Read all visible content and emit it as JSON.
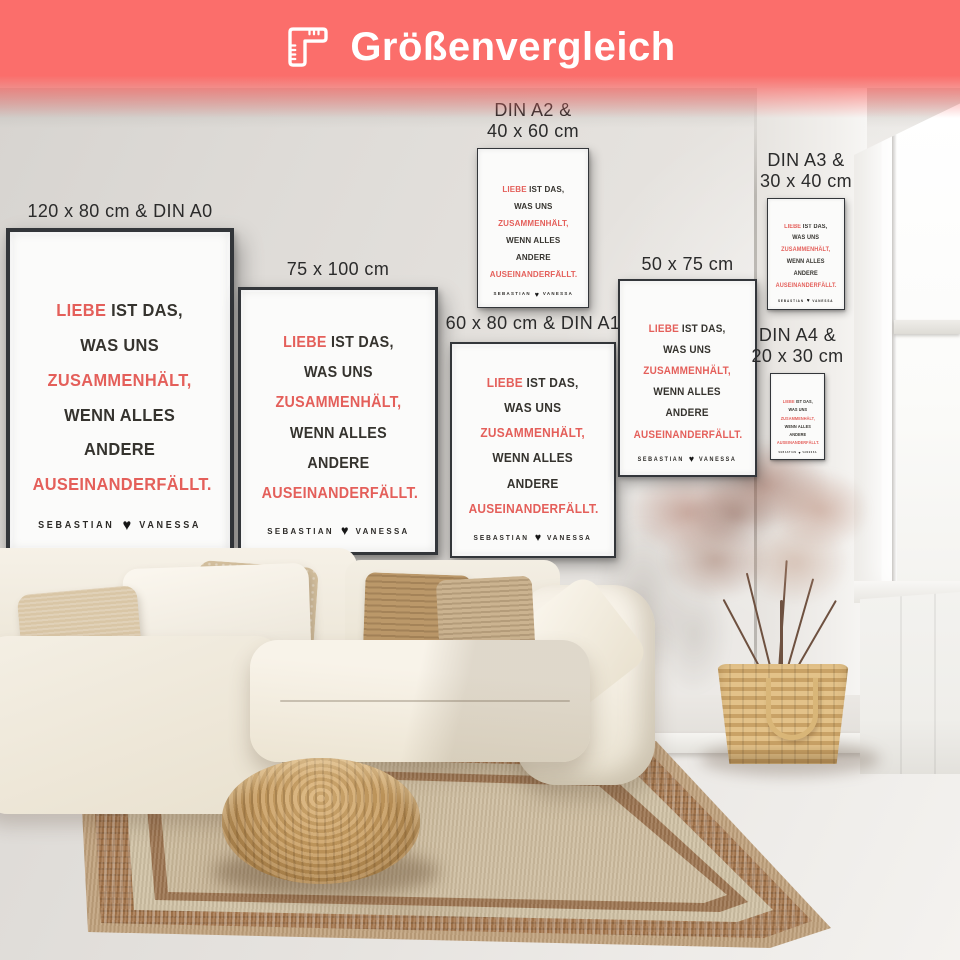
{
  "header": {
    "title": "Größenvergleich",
    "icon": "ruler-corner-icon",
    "bg_color": "#FB6E6B",
    "text_color": "#FFFFFF"
  },
  "poster_design": {
    "accent_color": "#E45F5A",
    "text_color": "#35332E",
    "frame_color": "#33363A",
    "quote": {
      "l1_accent": "Liebe",
      "l1_rest": " ist das,",
      "l2_rest": "was uns ",
      "l2_accent": "zusammenhält,",
      "l3": "wenn alles andere",
      "l4_accent": "auseinanderfällt.",
      "name_left": "Sebastian",
      "heart": "♥",
      "name_right": "Vanessa"
    },
    "photos": [
      "beach-sunset-couple-photo",
      "sitting-couple-photo",
      "beach-lift-couple-photo"
    ]
  },
  "posters": [
    {
      "id": "din-a0",
      "label_lines": [
        "120 x 80 cm & DIN A0"
      ]
    },
    {
      "id": "75x100",
      "label_lines": [
        "75 x 100 cm"
      ]
    },
    {
      "id": "din-a2",
      "label_lines": [
        "DIN A2 &",
        "40 x 60 cm"
      ]
    },
    {
      "id": "din-a1",
      "label_lines": [
        "60 x 80 cm & DIN A1"
      ]
    },
    {
      "id": "50x75",
      "label_lines": [
        "50 x 75 cm"
      ]
    },
    {
      "id": "din-a3",
      "label_lines": [
        "DIN A3 &",
        "30 x 40 cm"
      ]
    },
    {
      "id": "din-a4",
      "label_lines": [
        "DIN A4 &",
        "20 x 30 cm"
      ]
    }
  ],
  "scene": {
    "objects": [
      "cream-sectional-sofa",
      "throw-pillows",
      "rattan-pouf",
      "beige-bordered-rug",
      "wood-plank-floor",
      "dried-plant",
      "woven-basket",
      "window",
      "radiator-cabinet"
    ]
  }
}
